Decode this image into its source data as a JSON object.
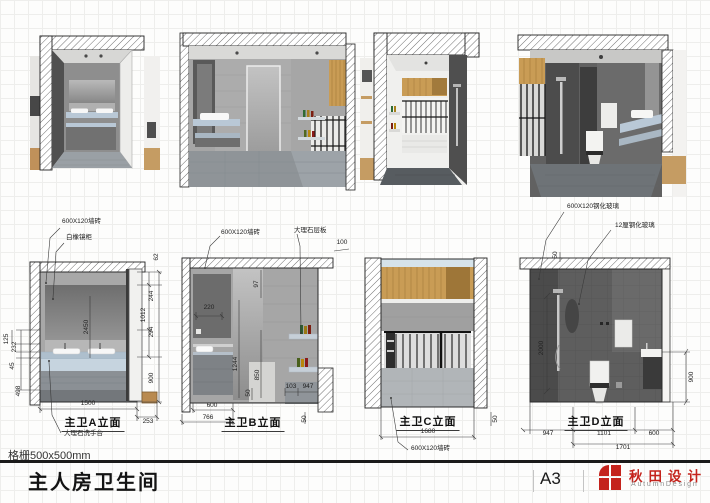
{
  "titlebar": {
    "note": "格栅500x500mm",
    "title": "主人房卫生间",
    "paper_size": "A3",
    "brand_cn": "秋田设计",
    "brand_en": "AutumnDesign",
    "brand_color": "#c4231c"
  },
  "elev_a": {
    "label": "主卫A立面",
    "ann_tile": "600X120墙砖",
    "ann_mirror": "白橡镜柜",
    "ann_counter": "大理石洗手台",
    "dim_62": "62",
    "dim_244": "244",
    "dim_1012": "1012",
    "dim_294": "294",
    "dim_900": "900",
    "dim_2450": "2450",
    "dim_125": "125",
    "dim_232": "232",
    "dim_45": "45",
    "dim_498": "498",
    "dim_1500": "1500",
    "dim_253": "253"
  },
  "elev_b": {
    "label": "主卫B立面",
    "ann_tile": "600X120墙砖",
    "ann_shelf": "大理石层板",
    "dim_220": "220",
    "dim_97": "97",
    "dim_100": "100",
    "dim_1244": "1244",
    "dim_850": "850",
    "dim_50a": "50",
    "dim_103": "103",
    "dim_947": "947",
    "dim_600": "600",
    "dim_766": "766",
    "dim_50b": "50"
  },
  "elev_c": {
    "label": "主卫C立面",
    "ann_tile": "600X120墙砖",
    "dim_1680": "1680",
    "dim_50": "50"
  },
  "elev_d": {
    "label": "主卫D立面",
    "ann_glass_tile": "600X120钢化玻璃",
    "ann_glass": "12厘钢化玻璃",
    "dim_50": "50",
    "dim_2000": "2000",
    "dim_900": "900",
    "dim_947": "947",
    "dim_1101": "1101",
    "dim_600": "600",
    "dim_1701": "1701"
  }
}
